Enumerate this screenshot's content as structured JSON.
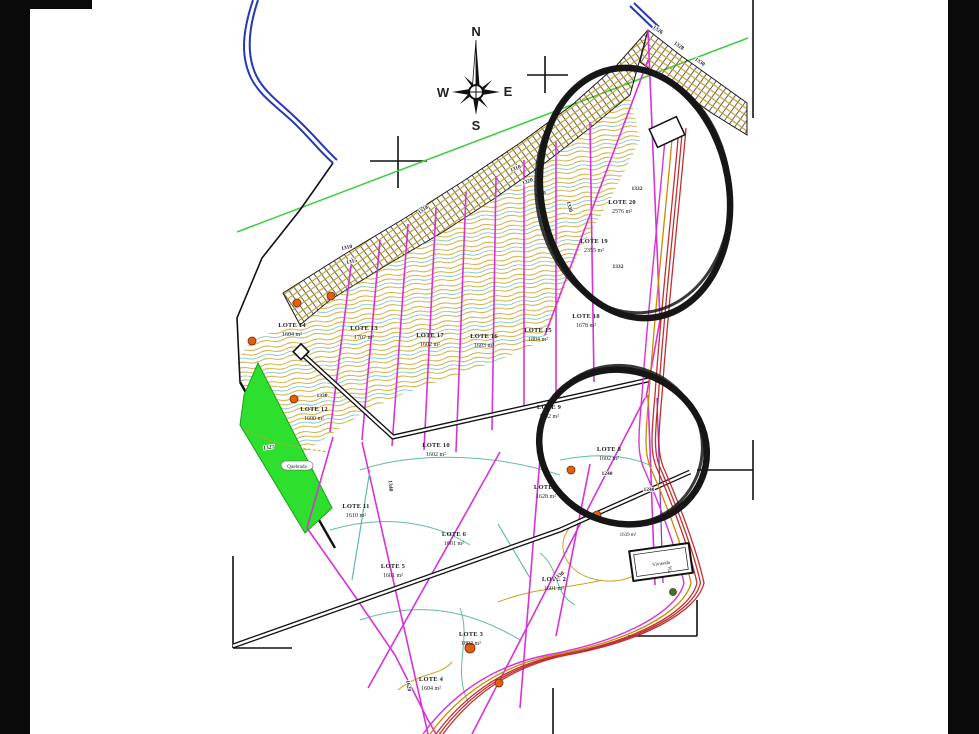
{
  "title": "Subdivision survey plan (plano de loteo) with contour lines",
  "compass": {
    "n": "N",
    "e": "E",
    "s": "S",
    "w": "W"
  },
  "lots": [
    {
      "name": "LOTE 20",
      "area": "2576 m²"
    },
    {
      "name": "LOTE 19",
      "area": "2355 m²"
    },
    {
      "name": "LOTE 18",
      "area": "1678 m²"
    },
    {
      "name": "LOTE 15",
      "area": "1804 m²"
    },
    {
      "name": "LOTE 16",
      "area": "1603 m²"
    },
    {
      "name": "LOTE 17",
      "area": "1602 m²"
    },
    {
      "name": "LOTE 13",
      "area": "1707 m²"
    },
    {
      "name": "LOTE 14",
      "area": "1604 m²"
    },
    {
      "name": "LOTE 12",
      "area": "1600 m²"
    },
    {
      "name": "LOTE 10",
      "area": "1602 m²"
    },
    {
      "name": "LOTE 9",
      "area": "1602 m²"
    },
    {
      "name": "LOTE 8",
      "area": "1602 m²"
    },
    {
      "name": "LOTE 7",
      "area": "1628 m²"
    },
    {
      "name": "LOTE 11",
      "area": "1610 m²"
    },
    {
      "name": "LOTE 6",
      "area": "1601 m²"
    },
    {
      "name": "LOTE 5",
      "area": "1601 m²"
    },
    {
      "name": "LOTE 2",
      "area": "1601 m²"
    },
    {
      "name": "LOTE 3",
      "area": "1802 m²"
    },
    {
      "name": "LOTE 4",
      "area": "1604 m²"
    }
  ],
  "contours": [
    "1310",
    "1320",
    "1330",
    "1310",
    "1315",
    "1332",
    "1332",
    "1330",
    "1327",
    "1340",
    "1240",
    "1240",
    "1330",
    "1620",
    "1326",
    "1328",
    "1330",
    "1318",
    "1330"
  ],
  "annotations": {
    "house_label": "Vivienda",
    "house_area": "1639 m²",
    "quebrada": "Quebrada",
    "via": "Via"
  },
  "colors": {
    "contour_orange": "#c9a227",
    "contour_cyan": "#62b8ac",
    "boundary_magenta": "#d633d6",
    "road_red": "#c03030",
    "river_blue": "#2438b8",
    "green_area": "#2ee02e",
    "green_line": "#44cc44",
    "sketch_black": "#161616",
    "letterbox": "#0a0a0a"
  }
}
